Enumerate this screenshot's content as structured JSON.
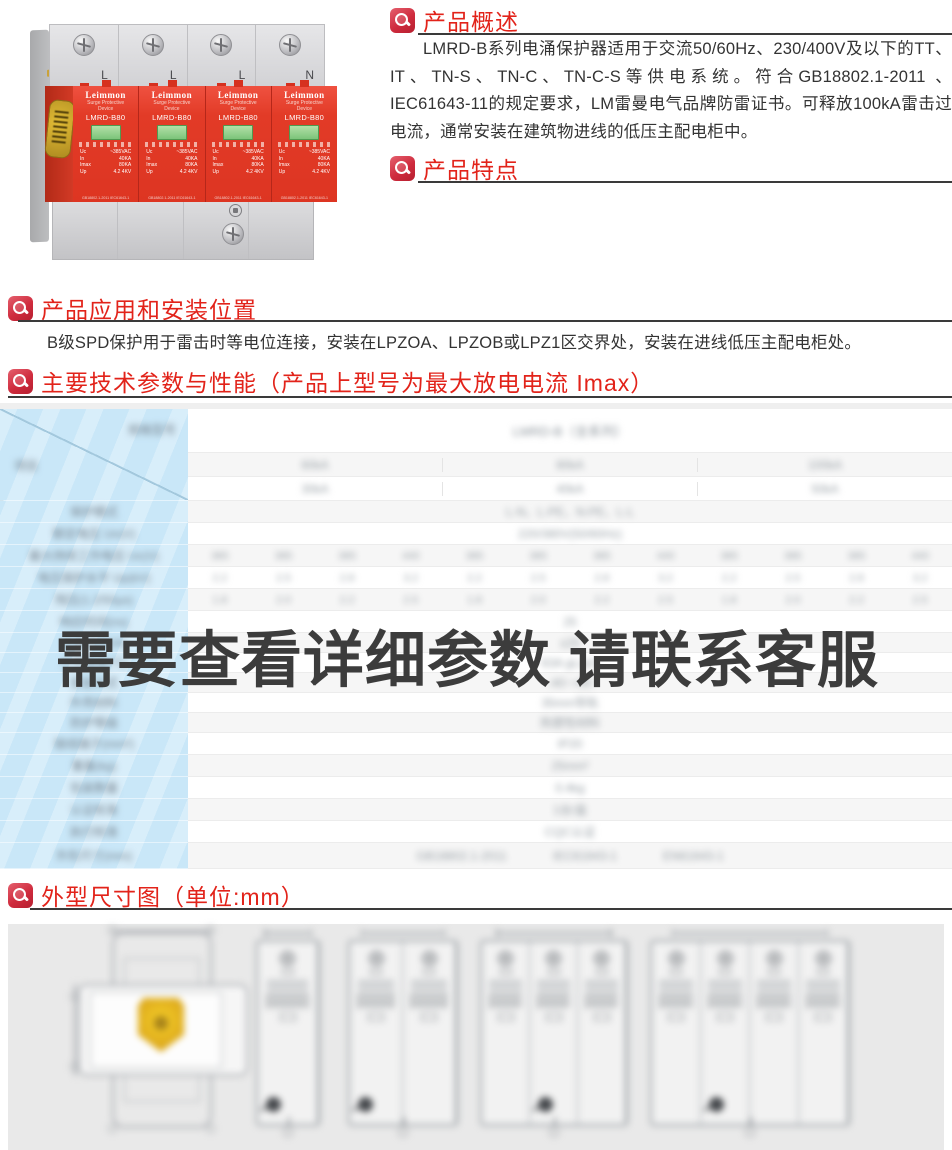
{
  "accent_red": "#e2231a",
  "sections": {
    "overview": {
      "title": "产品概述",
      "body": "LMRD-B系列电涌保护器适用于交流50/60Hz、230/400V及以下的TT、IT、TN-S、TN-C、TN-C-S等供电系统。符合GB18802.1-2011 、IEC61643-11的规定要求，LM雷曼电气品牌防雷证书。可释放100kA雷击过电流，通常安装在建筑物进线的低压主配电柜中。"
    },
    "features": {
      "title": "产品特点",
      "items": [
        "模块式-无需停电即可更换保护器单元",
        "大电流-最高可承受100kA(8/20us)",
        "高速-动作反应时间少于25ns",
        "状态显示-窗口颜色表示保护器工作状态；绿色(正常)，红色(故障)"
      ]
    },
    "application": {
      "title": "产品应用和安装位置",
      "body": "B级SPD保护用于雷击时等电位连接，安装在LPZOA、LPZOB或LPZ1区交界处，安装在进线低压主配电柜处。"
    },
    "parameters": {
      "title": "主要技术参数与性能（产品上型号为最大放电电流 Imax）"
    },
    "dimensions": {
      "title": "外型尺寸图（单位:mm）"
    }
  },
  "product_photo": {
    "terminal_labels": [
      "L",
      "L",
      "L",
      "N"
    ],
    "module_count": 4,
    "module": {
      "brand": "Leimmon",
      "sub1": "Surge Protective",
      "sub2": "Device",
      "model": "LMRD-B80",
      "specs": [
        [
          "Uc",
          "~385VAC"
        ],
        [
          "In",
          "40KA"
        ],
        [
          "Imax",
          "80KA"
        ],
        [
          "Up",
          "4.2 4KV"
        ]
      ],
      "footer": "GB18802.1-2011 IEC61643-1"
    },
    "window_color_green": "#8fd08a",
    "body_red": "#e2402d"
  },
  "table": {
    "note": "table content is blurred/illegible in source; placeholder strings below only mimic blur shapes",
    "overlay_text": "需要查看详细参数 请联系客服",
    "left_header_top_placeholder": "规格型号",
    "left_header_bottom_placeholder": "项目",
    "left_labels_placeholder": [
      "保护模式",
      "额定电压 Un(V)",
      "最大持续工作电压 Uc(V)",
      "电压保护水平 Up(kV)",
      "残压(1.2/50μs)",
      "响应时间(ns)",
      "后备保护(A)",
      "工作温度(℃)",
      "安装方式",
      "外壳材料",
      "防护等级",
      "接线端子(mm²)",
      "重量(kg)",
      "包装数量",
      "认证标准",
      "执行标准",
      "外形尺寸(mm)"
    ],
    "rows_placeholder": [
      {
        "h": 44,
        "kind": "title",
        "cells": [
          "LMRD-B（全系列）"
        ]
      },
      {
        "h": 24,
        "kind": "group3",
        "cells": [
          "60kA",
          "80kA",
          "100kA"
        ]
      },
      {
        "h": 24,
        "kind": "group3",
        "cells": [
          "30kA",
          "40kA",
          "50kA"
        ]
      },
      {
        "h": 22,
        "kind": "center",
        "cells": [
          "L-N、L-PE、N-PE、L-L"
        ]
      },
      {
        "h": 22,
        "kind": "center",
        "cells": [
          "220/380V(50/60Hz)"
        ]
      },
      {
        "h": 22,
        "kind": "cols12",
        "cells": [
          "385",
          "385",
          "385",
          "440",
          "385",
          "385",
          "385",
          "440",
          "385",
          "385",
          "385",
          "440"
        ]
      },
      {
        "h": 22,
        "kind": "cols12",
        "cells": [
          "2.2",
          "2.5",
          "2.8",
          "3.2",
          "2.2",
          "2.5",
          "2.8",
          "3.2",
          "2.2",
          "2.5",
          "2.8",
          "3.2"
        ]
      },
      {
        "h": 22,
        "kind": "cols12",
        "cells": [
          "1.8",
          "2.0",
          "2.2",
          "2.5",
          "1.8",
          "2.0",
          "2.2",
          "2.5",
          "1.8",
          "2.0",
          "2.2",
          "2.5"
        ]
      },
      {
        "h": 22,
        "kind": "center",
        "cells": [
          "25"
        ]
      },
      {
        "h": 20,
        "kind": "center",
        "cells": [
          "≤25"
        ]
      },
      {
        "h": 20,
        "kind": "center",
        "cells": [
          "63A gL/gG"
        ]
      },
      {
        "h": 20,
        "kind": "center",
        "cells": [
          "-40~+80"
        ]
      },
      {
        "h": 20,
        "kind": "center",
        "cells": [
          "35mm导轨"
        ]
      },
      {
        "h": 20,
        "kind": "center",
        "cells": [
          "热塑性材料"
        ]
      },
      {
        "h": 22,
        "kind": "center",
        "cells": [
          "IP20"
        ]
      },
      {
        "h": 22,
        "kind": "center",
        "cells": [
          "25mm²"
        ]
      },
      {
        "h": 22,
        "kind": "center",
        "cells": [
          "0.4kg"
        ]
      },
      {
        "h": 22,
        "kind": "center",
        "cells": [
          "1台/盒"
        ]
      },
      {
        "h": 22,
        "kind": "center",
        "cells": [
          "CQC认证"
        ]
      },
      {
        "h": 26,
        "kind": "group3b",
        "cells": [
          "GB18802.1-2011",
          "IEC61643-1",
          "EN61643-1"
        ]
      }
    ],
    "left_heights": [
      92,
      22,
      22,
      22,
      22,
      22,
      22,
      20,
      20,
      20,
      20,
      20,
      22,
      22,
      22,
      22,
      22,
      26
    ],
    "left_col_blue": "#c9e7f8"
  },
  "drawings": {
    "panel_gray": "#e9e9e9",
    "has_plan_view_with_yellow_shield": true,
    "module_counts": [
      1,
      2,
      3,
      4
    ]
  }
}
